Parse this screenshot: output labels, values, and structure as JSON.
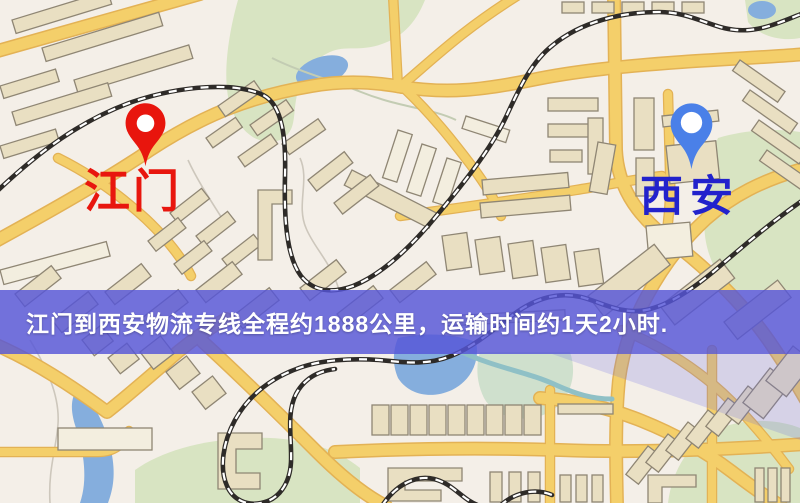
{
  "page": {
    "type": "logistics-route-map",
    "width_px": 800,
    "height_px": 503
  },
  "map": {
    "origin_marker": {
      "label": "江门",
      "pin_color": "#e8150d",
      "label_color": "#e8160e"
    },
    "destination_marker": {
      "label": "西安",
      "pin_color": "#4a80e8",
      "label_color": "#2222cc"
    },
    "palette": {
      "background": "#f4efe8",
      "road": "#f4cf6a",
      "road_casing": "#e3b255",
      "water": "#85aedd",
      "park": "#d8e4c2",
      "building": "#e9dfc2",
      "building_light": "#f3eedf",
      "building_outline": "#8f8674",
      "railway": "#2e2b28"
    }
  },
  "banner": {
    "text": "江门到西安物流专线全程约1888公里，运输时间约1天2小时.",
    "background": "#5555d8",
    "text_color": "#ffffff"
  }
}
